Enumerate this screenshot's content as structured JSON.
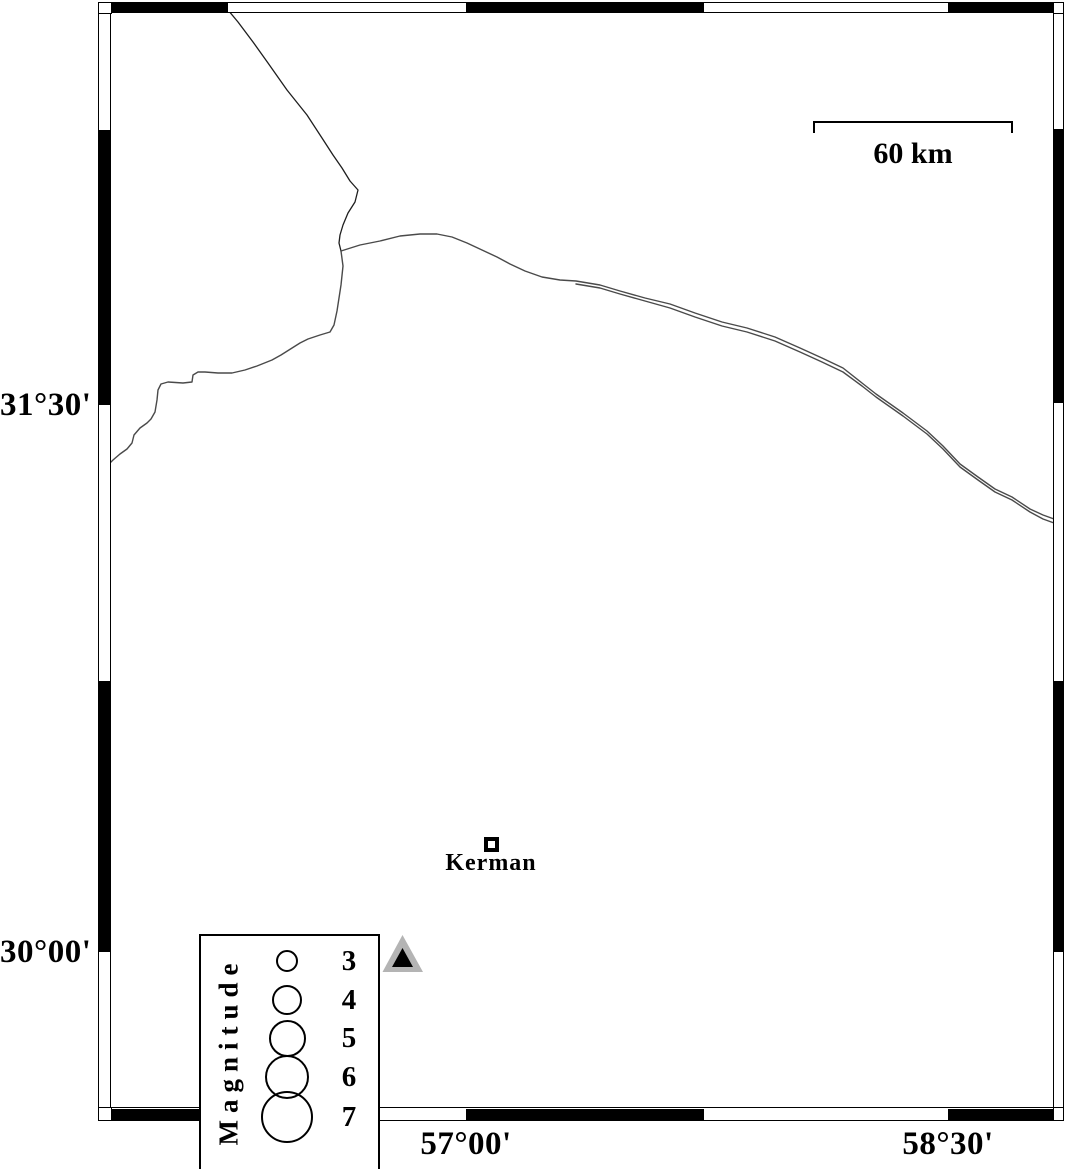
{
  "map": {
    "lat_labels": [
      {
        "text": "31°30'"
      },
      {
        "text": "30°00'"
      }
    ],
    "lon_labels": [
      {
        "text": "57°00'"
      },
      {
        "text": "58°30'"
      }
    ],
    "scale_bar": {
      "label": "60 km"
    },
    "city": {
      "name": "Kerman",
      "marker": "square-marker"
    },
    "station_marker": "triangle-marker",
    "features": [
      "map-line-north",
      "map-line-east-double",
      "map-line-southwest"
    ]
  },
  "legend": {
    "title": "Magnitude",
    "items": [
      {
        "magnitude": "3"
      },
      {
        "magnitude": "4"
      },
      {
        "magnitude": "5"
      },
      {
        "magnitude": "6"
      },
      {
        "magnitude": "7"
      }
    ]
  },
  "theme": {
    "ink": "#000000",
    "line": "#4a4a4a",
    "line-dark": "#1e1e1e",
    "station-gray": "#b4b4b4",
    "bg": "#ffffff"
  }
}
